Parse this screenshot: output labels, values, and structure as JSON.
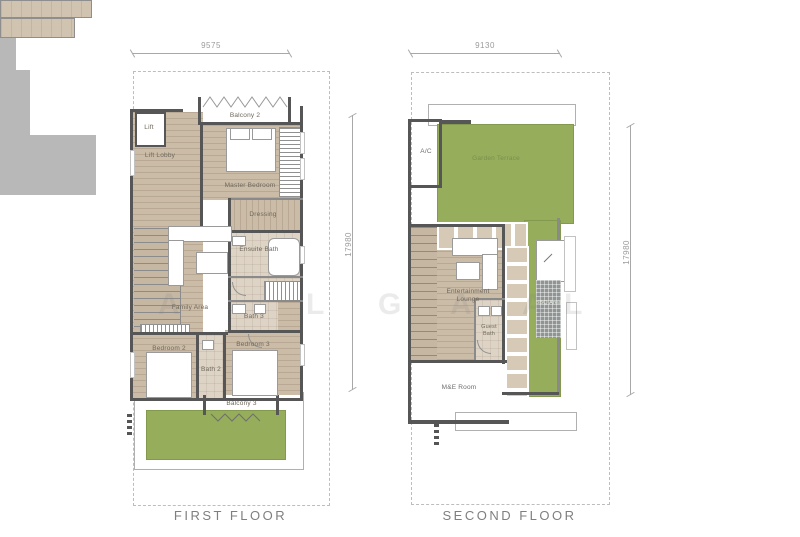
{
  "plans": [
    {
      "title": "FIRST FLOOR",
      "width_dim": "9575",
      "height_dim": "17980",
      "rooms": {
        "lift": "Lift",
        "lift_lobby": "Lift Lobby",
        "balcony2": "Balcony 2",
        "master": "Master Bedroom",
        "dressing": "Dressing",
        "ensuite": "Ensuite Bath",
        "family": "Family Area",
        "bath3": "Bath 3",
        "bedroom2": "Bedroom 2",
        "bath2": "Bath 2",
        "bedroom3": "Bedroom 3",
        "balcony3": "Balcony 3"
      }
    },
    {
      "title": "SECOND FLOOR",
      "width_dim": "9130",
      "height_dim": "17980",
      "rooms": {
        "ac": "A/C",
        "garden": "Garden Terrace",
        "lounge": "Entertainment Lounge",
        "guest_bath": "Guest Bath",
        "bbq": "BBQ Area",
        "me": "M&E Room"
      }
    }
  ],
  "watermark": {
    "l0": "A",
    "l1": "L",
    "l2": "G",
    "l3": "A",
    "l4": "A",
    "l5": "L"
  },
  "colors": {
    "wood_floor": "#cbbca7",
    "bath_tile": "#ded4c6",
    "garden_green": "#96ad5c",
    "wall": "#565656",
    "utility_gray": "#b8b8b8",
    "balcony": "#d0c3b0",
    "plot_dash": "#bdbdbd",
    "dimension": "#9b9b9b",
    "room_label": "#6f685c",
    "title": "#7f7f7f"
  }
}
